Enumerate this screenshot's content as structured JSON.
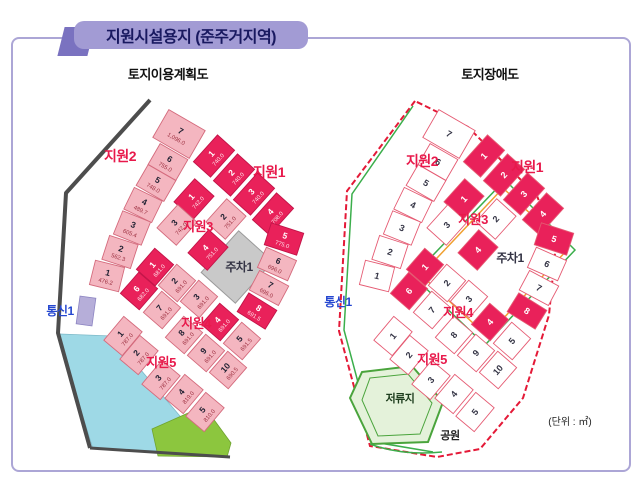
{
  "title": "지원시설용지 (준주거지역)",
  "unit_note": "(단위 : ㎡)",
  "left_map": {
    "heading": "토지이용계획도",
    "parking_label": "주차1",
    "comm_label": "통신1",
    "blocks": [
      {
        "name": "지원2",
        "lots": [
          {
            "n": 1,
            "area": "476.2"
          },
          {
            "n": 2,
            "area": "562.3"
          },
          {
            "n": 3,
            "area": "605.4"
          },
          {
            "n": 4,
            "area": "489.7"
          },
          {
            "n": 5,
            "area": "748.0"
          },
          {
            "n": 6,
            "area": "755.0"
          },
          {
            "n": 7,
            "area": "1,096.0"
          }
        ]
      },
      {
        "name": "지원1",
        "lots": [
          {
            "n": 1,
            "area": "740.0",
            "hl": true
          },
          {
            "n": 2,
            "area": "740.0",
            "hl": true
          },
          {
            "n": 3,
            "area": "740.0",
            "hl": true
          },
          {
            "n": 4,
            "area": "708.0",
            "hl": true
          },
          {
            "n": 5,
            "area": "775.0",
            "hl": true
          },
          {
            "n": 6,
            "area": "696.0"
          },
          {
            "n": 7,
            "area": "696.0"
          },
          {
            "n": 8,
            "area": "691.5",
            "hl": true
          }
        ]
      },
      {
        "name": "지원3",
        "lots": [
          {
            "n": 1,
            "area": "742.0",
            "hl": true
          },
          {
            "n": 2,
            "area": "751.0"
          },
          {
            "n": 3,
            "area": "742.0"
          },
          {
            "n": 4,
            "area": "751.0",
            "hl": true
          }
        ]
      },
      {
        "name": "지원4",
        "lots": [
          {
            "n": 1,
            "area": "681.0",
            "hl": true
          },
          {
            "n": 2,
            "area": "691.0"
          },
          {
            "n": 3,
            "area": "691.0"
          },
          {
            "n": 4,
            "area": "691.0",
            "hl": true
          },
          {
            "n": 5,
            "area": "691.5"
          },
          {
            "n": 6,
            "area": "682.0",
            "hl": true
          },
          {
            "n": 7,
            "area": "691.0"
          },
          {
            "n": 8,
            "area": "691.0"
          },
          {
            "n": 9,
            "area": "691.0"
          },
          {
            "n": 10,
            "area": "690.5"
          }
        ]
      },
      {
        "name": "지원5",
        "lots": [
          {
            "n": 1,
            "area": "787.0"
          },
          {
            "n": 2,
            "area": "787.0"
          },
          {
            "n": 3,
            "area": "787.0"
          },
          {
            "n": 4,
            "area": "819.0"
          },
          {
            "n": 5,
            "area": "810.0"
          }
        ]
      }
    ]
  },
  "right_map": {
    "heading": "토지장애도",
    "parking_label": "주차1",
    "comm_label": "통신1",
    "pond_label": "저류지",
    "park_label": "공원"
  },
  "colors": {
    "accent_purple": "#a29bd4",
    "lot_pink": "#f4b6c0",
    "lot_highlight": "#e9215a",
    "label_red": "#e8194b",
    "label_blue": "#2547d0",
    "parking_gray": "#c9c9c9",
    "water_cyan": "#9ed9e6",
    "park_green": "#8cc63e",
    "comm_lavender": "#b6aed9",
    "boundary_dark": "#4d4d4d",
    "boundary_green": "#3bae4b",
    "boundary_red": "#e41937",
    "road_orange": "#f0a030"
  }
}
